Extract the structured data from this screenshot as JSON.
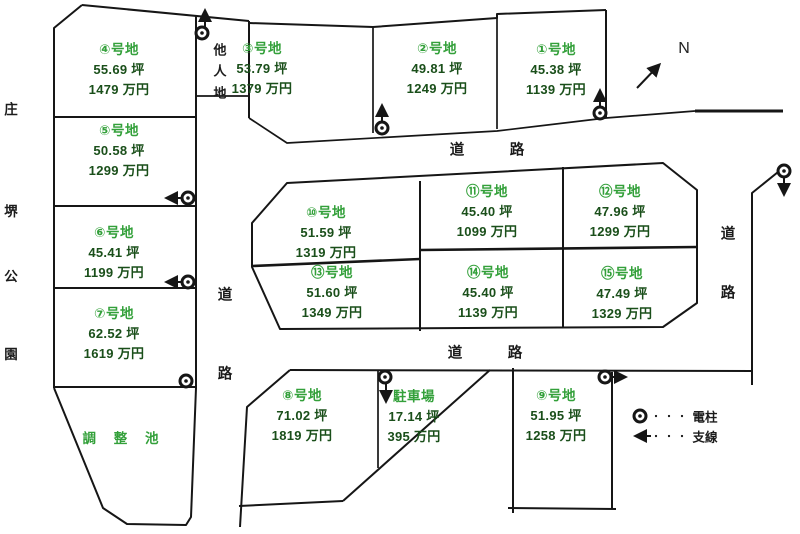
{
  "title": "宅地分譲区画図",
  "colors": {
    "plot_name_green": "#33a03a",
    "value_green": "#1a4f1a",
    "line_color": "#161616",
    "text_black": "#1c1c1c"
  },
  "compass": {
    "label": "N"
  },
  "park": {
    "chars": [
      "庄",
      "堺",
      "公",
      "園"
    ]
  },
  "other_land": {
    "chars": [
      "他",
      "人",
      "地"
    ]
  },
  "pond": {
    "label": "調 整 池"
  },
  "roads": {
    "char1": "道",
    "char2": "路"
  },
  "plots": [
    {
      "name": "①号地",
      "area": "45.38 坪",
      "price": "1139 万円"
    },
    {
      "name": "②号地",
      "area": "49.81 坪",
      "price": "1249 万円"
    },
    {
      "name": "③号地",
      "area": "53.79 坪",
      "price": "1379 万円"
    },
    {
      "name": "④号地",
      "area": "55.69 坪",
      "price": "1479 万円"
    },
    {
      "name": "⑤号地",
      "area": "50.58 坪",
      "price": "1299 万円"
    },
    {
      "name": "⑥号地",
      "area": "45.41 坪",
      "price": "1199 万円"
    },
    {
      "name": "⑦号地",
      "area": "62.52 坪",
      "price": "1619 万円"
    },
    {
      "name": "⑧号地",
      "area": "71.02 坪",
      "price": "1819 万円"
    },
    {
      "name": "⑨号地",
      "area": "51.95 坪",
      "price": "1258 万円"
    },
    {
      "name": "⑩号地",
      "area": "51.59 坪",
      "price": "1319 万円"
    },
    {
      "name": "⑪号地",
      "area": "45.40 坪",
      "price": "1099 万円"
    },
    {
      "name": "⑫号地",
      "area": "47.96 坪",
      "price": "1299 万円"
    },
    {
      "name": "⑬号地",
      "area": "51.60 坪",
      "price": "1349 万円"
    },
    {
      "name": "⑭号地",
      "area": "45.40 坪",
      "price": "1139 万円"
    },
    {
      "name": "⑮号地",
      "area": "47.49 坪",
      "price": "1329 万円"
    }
  ],
  "parking": {
    "name": "駐車場",
    "area": "17.14 坪",
    "price": "395 万円"
  },
  "legend": {
    "dots": "・・・",
    "pole_label": "電柱",
    "wire_label": "支線"
  }
}
